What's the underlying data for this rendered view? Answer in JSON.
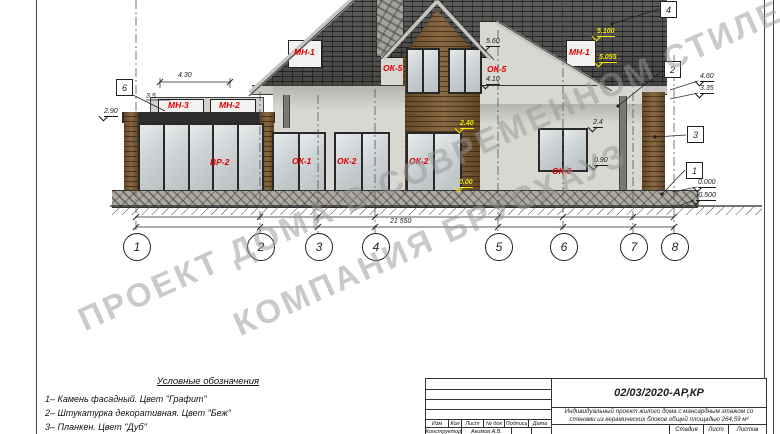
{
  "sheet": {
    "watermark_line1": "ПРОЕКТ ДОМА В СОВРЕМЕННОМ СТИЛЕ",
    "watermark_line2": "КОМПАНИЯ БРУСХАУЗ"
  },
  "colors": {
    "roof": "#4e4d4b",
    "wood": "#7a5830",
    "stucco": "#d8d7d2",
    "stone_base": "#aeaba2",
    "label_red": "#e10000",
    "label_yellow": "#f2ed00",
    "watermark_gray": "#969696"
  },
  "annotations": {
    "red_labels": [
      {
        "text": "МН-3",
        "x": 168,
        "y": 101
      },
      {
        "text": "МН-2",
        "x": 219,
        "y": 101
      },
      {
        "text": "МН-1",
        "x": 294,
        "y": 48
      },
      {
        "text": "ОК-5",
        "x": 383,
        "y": 64
      },
      {
        "text": "ОК-5",
        "x": 487,
        "y": 65
      },
      {
        "text": "МН-1",
        "x": 569,
        "y": 48
      },
      {
        "text": "ВР-2",
        "x": 210,
        "y": 158
      },
      {
        "text": "ОК-1",
        "x": 292,
        "y": 157
      },
      {
        "text": "ОК-2",
        "x": 337,
        "y": 157
      },
      {
        "text": "ОК-2",
        "x": 409,
        "y": 157
      },
      {
        "text": "ОК-3",
        "x": 552,
        "y": 167
      }
    ],
    "yellow_labels": [
      {
        "text": "5.100",
        "x": 597,
        "y": 28
      },
      {
        "text": "5.055",
        "x": 599,
        "y": 54
      },
      {
        "text": "2.40",
        "x": 460,
        "y": 120
      },
      {
        "text": "0.00",
        "x": 459,
        "y": 179
      }
    ],
    "dim_labels": [
      {
        "text": "4.30",
        "x": 178,
        "y": 72,
        "ul": false,
        "mark": false
      },
      {
        "text": "3.5",
        "x": 146,
        "y": 93,
        "ul": false,
        "mark": false
      },
      {
        "text": "2.90",
        "x": 104,
        "y": 108,
        "ul": true,
        "mark": true
      },
      {
        "text": "5.60",
        "x": 486,
        "y": 38,
        "ul": true,
        "mark": true
      },
      {
        "text": "4.10",
        "x": 486,
        "y": 76,
        "ul": true,
        "mark": true
      },
      {
        "text": "2.4",
        "x": 593,
        "y": 119,
        "ul": true,
        "mark": true
      },
      {
        "text": "0.90",
        "x": 594,
        "y": 157,
        "ul": true,
        "mark": true
      },
      {
        "text": "4.60",
        "x": 700,
        "y": 73,
        "ul": true,
        "mark": true
      },
      {
        "text": "3.35",
        "x": 700,
        "y": 85,
        "ul": true,
        "mark": true
      },
      {
        "text": "0.000",
        "x": 698,
        "y": 179,
        "ul": true,
        "mark": true
      },
      {
        "text": "-0.500",
        "x": 696,
        "y": 192,
        "ul": true,
        "mark": true
      },
      {
        "text": "21 550",
        "x": 390,
        "y": 218,
        "ul": false,
        "mark": false
      }
    ],
    "material_callouts": [
      {
        "num": "6",
        "x": 116,
        "y": 79
      },
      {
        "num": "4",
        "x": 660,
        "y": 1
      },
      {
        "num": "2",
        "x": 664,
        "y": 61
      },
      {
        "num": "3",
        "x": 687,
        "y": 126
      },
      {
        "num": "1",
        "x": 686,
        "y": 162
      }
    ],
    "axis_bubbles": [
      {
        "num": "1",
        "x": 136
      },
      {
        "num": "2",
        "x": 260
      },
      {
        "num": "3",
        "x": 318
      },
      {
        "num": "4",
        "x": 375
      },
      {
        "num": "5",
        "x": 498
      },
      {
        "num": "6",
        "x": 563
      },
      {
        "num": "7",
        "x": 633
      },
      {
        "num": "8",
        "x": 674
      }
    ]
  },
  "legend": {
    "title": "Условные обозначения",
    "items": [
      "1– Камень фасадный. Цвет \"Графит\"",
      "2– Штукатурка декоративная. Цвет \"Беж\"",
      "3– Планкен. Цвет \"Дуб\""
    ]
  },
  "title_block": {
    "doc_number": "02/03/2020-АР,КР",
    "description": "Индивидуальный проект жилого дома с мансардным этажом со стенами из керамических блоков общей площадью 264,59 м²",
    "header_cells": [
      "Изм",
      "Кол",
      "Лист",
      "№ док",
      "Подпись",
      "Дата"
    ],
    "role": "Конструктор",
    "name": "Акимов А.В.",
    "stage_label": "Стадия",
    "sheet_label": "Лист",
    "sheets_label": "Листов"
  }
}
